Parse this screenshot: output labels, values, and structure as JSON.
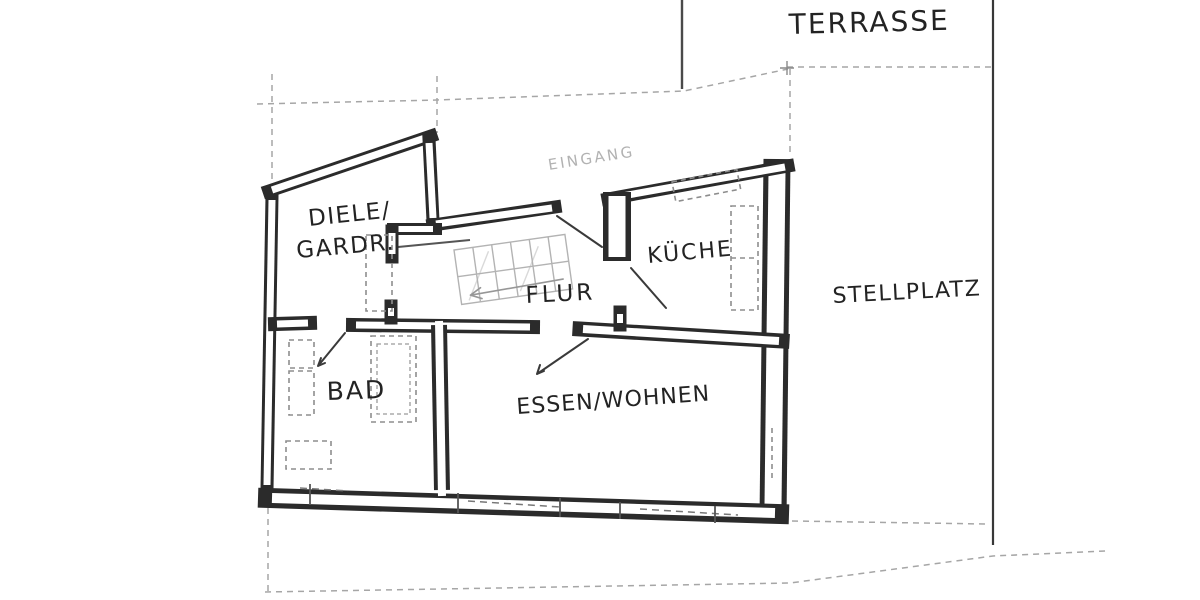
{
  "document": {
    "kind": "scanned hand-drawn floor plan sketch",
    "background_color": "#ffffff",
    "ink_color": "#2b2b2b",
    "pencil_color": "#a6a6a6"
  },
  "labels": {
    "terrasse": "TERRASSE",
    "stellplatz": "STELLPLATZ",
    "diele_line1": "DIELE/",
    "diele_line2": "GARDR.",
    "kueche": "KÜCHE",
    "flur": "FLUR",
    "bad": "BAD",
    "essen_wohnen": "ESSEN/WOHNEN",
    "eingang": "EINGANG"
  }
}
